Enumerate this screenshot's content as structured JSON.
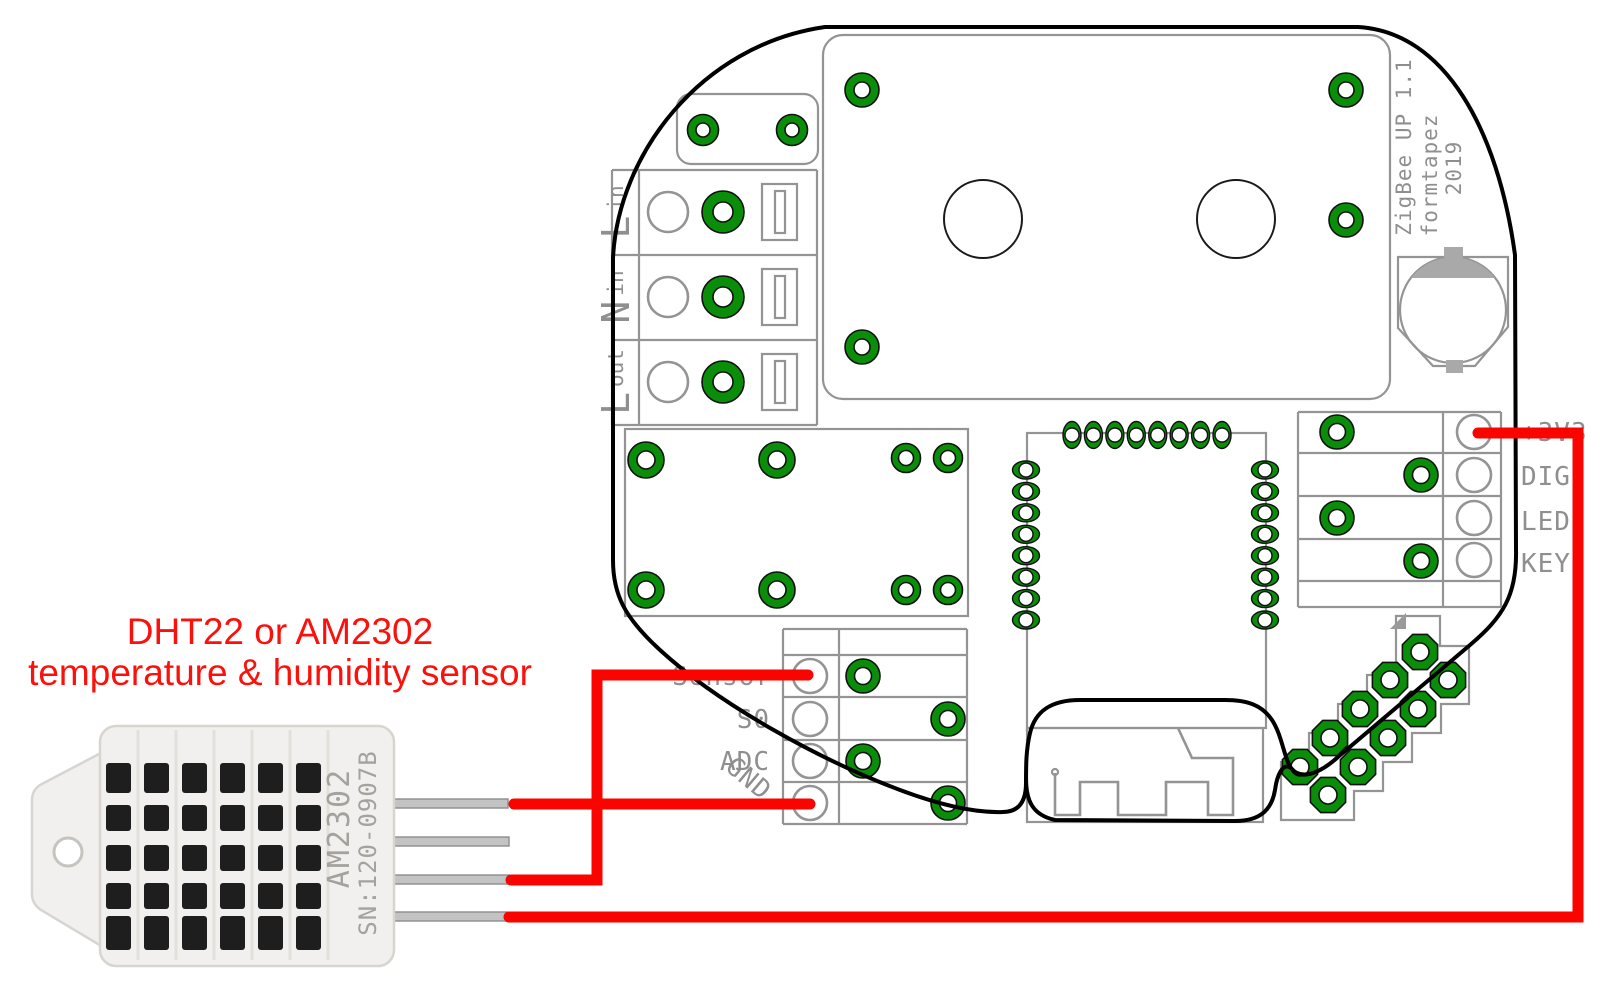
{
  "annotation": {
    "line1": "DHT22 or AM2302",
    "line2": "temperature & humidity sensor",
    "color": "#fb100c"
  },
  "board": {
    "credit": {
      "line1": "ZigBee UP 1.1",
      "line2": "formtapez",
      "line3": "2019"
    },
    "terminal_block": {
      "rows": [
        {
          "label": "L",
          "sub": "in"
        },
        {
          "label": "N",
          "sub": "in"
        },
        {
          "label": "L",
          "sub": "out"
        }
      ]
    },
    "sensor_header": {
      "labels": [
        "Sensor",
        "S0",
        "ADC",
        "GND"
      ]
    },
    "io_header": {
      "labels": [
        "+3V3",
        "DIG",
        "LED",
        "KEY"
      ]
    },
    "colors": {
      "pad_green": "#0a8e0a",
      "silkscreen_grey": "#8f8f8f",
      "outline_black": "#000000",
      "wire_red": "#fa0400"
    }
  },
  "sensor": {
    "marking_model": "AM2302",
    "marking_serial": "SN:120-0907B",
    "pins": 4
  },
  "connections": [
    {
      "sensor_pin": 1,
      "board_signal": "GND"
    },
    {
      "sensor_pin": 3,
      "board_signal": "Sensor"
    },
    {
      "sensor_pin": 4,
      "board_signal": "+3V3"
    }
  ]
}
